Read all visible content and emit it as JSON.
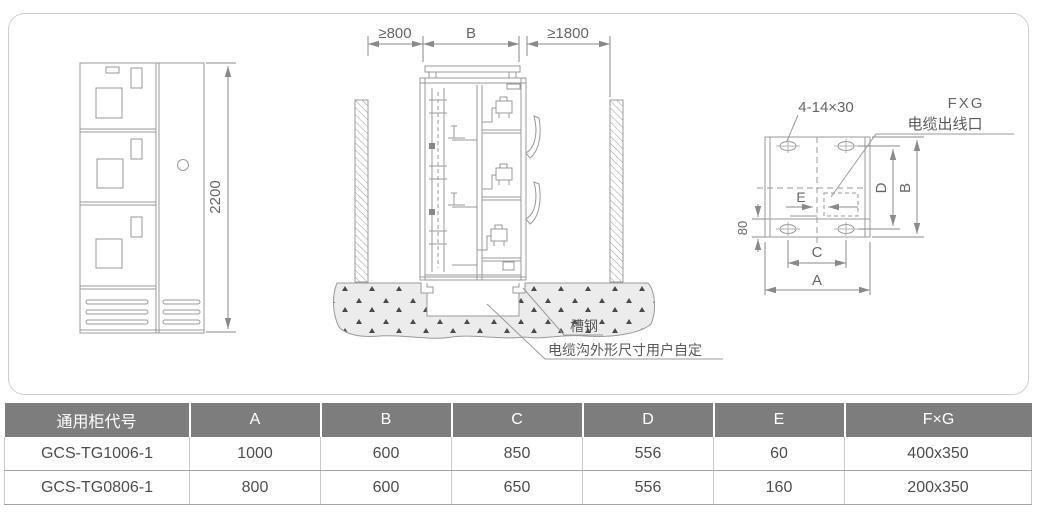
{
  "page": {
    "background": "#ffffff",
    "panel_border": "#cccccc"
  },
  "drawing": {
    "front_view": {
      "dim_height": "2200"
    },
    "side_view": {
      "dim_left_clearance": "≥800",
      "dim_cabinet_depth": "B",
      "dim_right_clearance": "≥1800",
      "label_channel_steel": "槽钢",
      "label_cable_trench": "电缆沟外形尺寸用户自定"
    },
    "top_view": {
      "label_mounting_holes": "4-14×30",
      "label_fxg": "FXG",
      "label_cable_outlet": "电缆出线口",
      "dim_d": "D",
      "dim_b": "B",
      "dim_80": "80",
      "dim_e": "E",
      "dim_c": "C",
      "dim_a": "A"
    }
  },
  "table": {
    "headers": [
      "通用柜代号",
      "A",
      "B",
      "C",
      "D",
      "E",
      "F×G"
    ],
    "rows": [
      [
        "GCS-TG1006-1",
        "1000",
        "600",
        "850",
        "556",
        "60",
        "400x350"
      ],
      [
        "GCS-TG0806-1",
        "800",
        "600",
        "650",
        "556",
        "160",
        "200x350"
      ]
    ],
    "header_bg": "#7d7d7d",
    "header_text": "#ffffff",
    "body_text": "#4d4d4d"
  }
}
